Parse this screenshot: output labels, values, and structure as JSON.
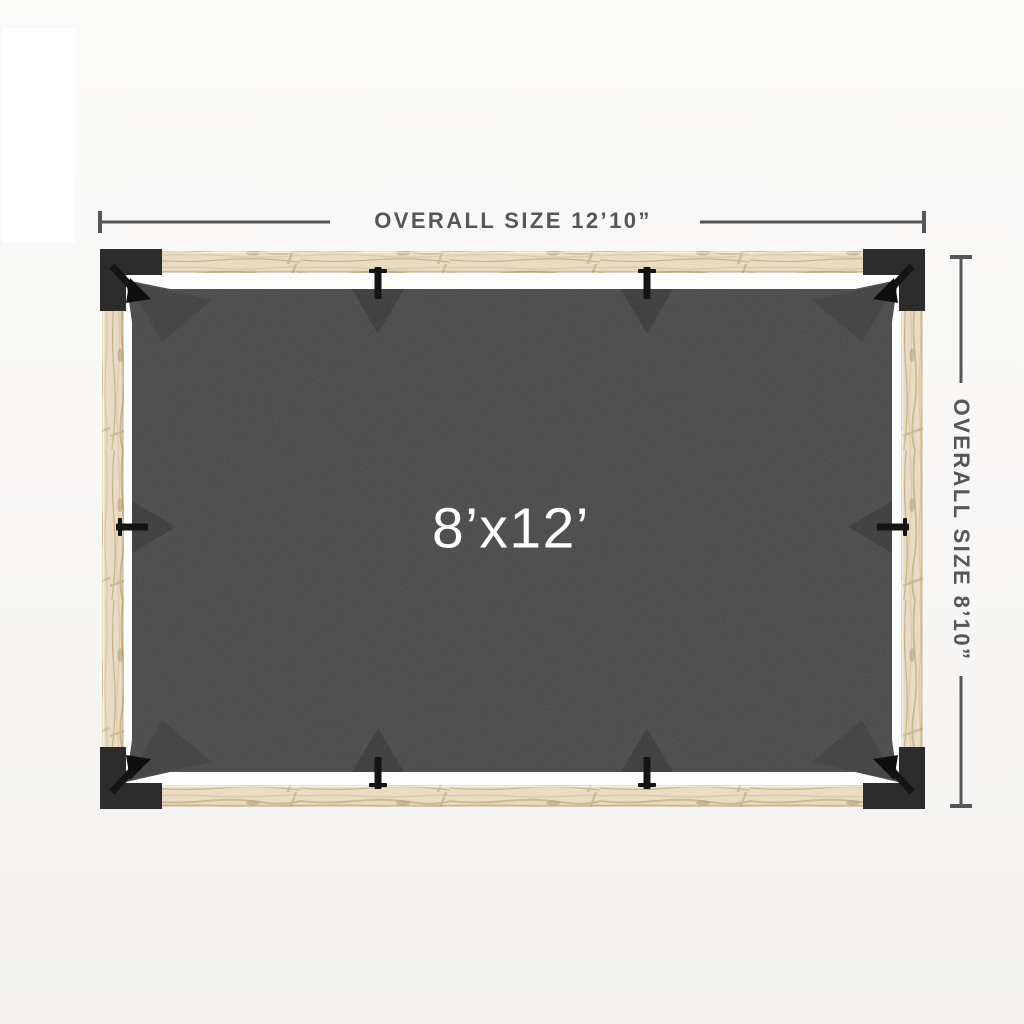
{
  "page": {
    "background_top": "#fafaf9",
    "background_bottom": "#f2f1ef"
  },
  "diagram": {
    "title": "Pergola top view with shade sail",
    "top_dimension": {
      "label": "OVERALL SIZE 12’10”"
    },
    "right_dimension": {
      "label": "OVERALL SIZE 8’10”"
    },
    "canvas": {
      "size_label": "8’x12’",
      "color": "#474747",
      "label_color": "#ffffff"
    },
    "frame": {
      "wood_color": "#e9dcc3",
      "bracket_color": "#2c2c2c",
      "strap_color": "#141414"
    },
    "dimension_color": "#55565a"
  }
}
